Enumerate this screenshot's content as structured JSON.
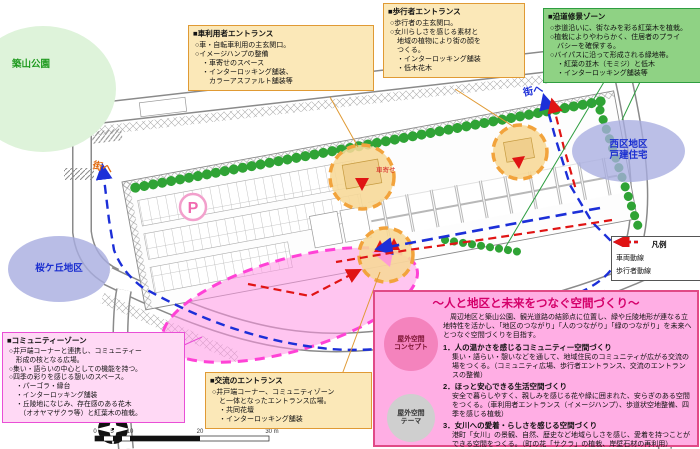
{
  "box_car": {
    "title": "■車利用者エントランス",
    "lines": [
      "○車・自転車利用の主玄関口。",
      "○イメージハンプの整備",
      "・車寄せのスペース",
      "・インターロッキング舗装、",
      "　カラーアスファルト舗装等"
    ]
  },
  "box_ped": {
    "title": "■歩行者エントランス",
    "lines": [
      "○歩行者の主玄関口。",
      "○女川らしさを感じる素材と",
      "　地域の植物により街の顔を",
      "　つくる。",
      "・インターロッキング舗装",
      "・低木花木"
    ]
  },
  "box_zone": {
    "title": "■沿道修景ゾーン",
    "lines": [
      "○歩道沿いに、街なみを彩る紅葉木を植栽。",
      "○植栽によりやわらかく、住居者のプライ",
      "　バシーを確保する。",
      "○バイパスに沿って形成される緑地帯。",
      "・紅葉の並木（モミジ）と低木",
      "・インターロッキング舗装等"
    ]
  },
  "box_comm": {
    "title": "■コミュニティーゾーン",
    "lines": [
      "○井戸端コーナーと連携し、コミュニティー",
      "　形成の核となる広場。",
      "○集い・語らいの中心としての機能を持つ。",
      "○四季の彩りを感じる憩いのスペース。",
      "・パーゴラ・縁台",
      "・インターロッキング舗装",
      "・丘陵地になじみ、存在感のある花木",
      "　（オオヤマザクラ等）と紅葉木の植栽。"
    ]
  },
  "box_exch": {
    "title": "■交流のエントランス",
    "lines": [
      "○井戸端コーナー、コミュニティゾーン",
      "　と一体となったエントランス広場。",
      "・共同花壇",
      "・インターロッキング舗装"
    ]
  },
  "legend": {
    "title": "凡例",
    "items": [
      {
        "label": "車両動線",
        "color": "#1c2fd8"
      },
      {
        "label": "歩行者動線",
        "color": "#e01414"
      }
    ]
  },
  "main_panel": {
    "title": "～人と地区と未来をつなぐ空間づくり～",
    "concept_badge_line1": "屋外空間",
    "concept_badge_line2": "コンセプト",
    "concept_text": "周辺地区と築山公園、観光道路の結節点に位置し、緑や丘陵地形が連なる立地特性を活かし、「地区のつながり」「人のつながり」「緑のつながり」を未来へとつなぐ空間づくりを目指す。",
    "theme_badge_line1": "屋外空間",
    "theme_badge_line2": "テーマ",
    "themes": [
      {
        "head": "1．人の温かさを感じるコミュニティー空間づくり",
        "body": "集い・語らい・憩いなどを通して、地域住民のコミュニティが広がる交流の場をつくる。（コミュニティ広場、歩行者エントランス、交流のエントランスの整備）"
      },
      {
        "head": "2．ほっと安心できる生活空間づくり",
        "body": "安全で暮らしやすく、親しみを感じる花や緑に囲まれた、安らぎのある空間をつくる。（車利用者エントランス（イメージハンプ）、歩道状空地整備、四季を感じる植栽）"
      },
      {
        "head": "3．女川への愛着・らしさを感じる空間づくり",
        "body": "港町「女川」の景観、自然、歴史など地域らしさを感じ、愛着を持つことができる空間をつくる。（町の花「サクラ」の植栽、岸壁石材の再利用）"
      }
    ]
  },
  "map_labels": {
    "park": "築山公園",
    "west_line1": "西区地区",
    "west_line2": "戸建住宅",
    "sakura": "桜ケ丘地区",
    "to_town_right": "街へ",
    "to_town_left": "街へ",
    "parking": "P",
    "kuruma_yose": "車寄せ",
    "compass_n": "N",
    "scale": [
      "0",
      "5",
      "10",
      "20",
      "30 m"
    ]
  },
  "colors": {
    "vehicle_route": "#1c2fd8",
    "pedestrian_route": "#e01414",
    "entrance_accent": "#f2a33c",
    "greenery": "#2fa335",
    "community_pink": "#ff42d6"
  }
}
